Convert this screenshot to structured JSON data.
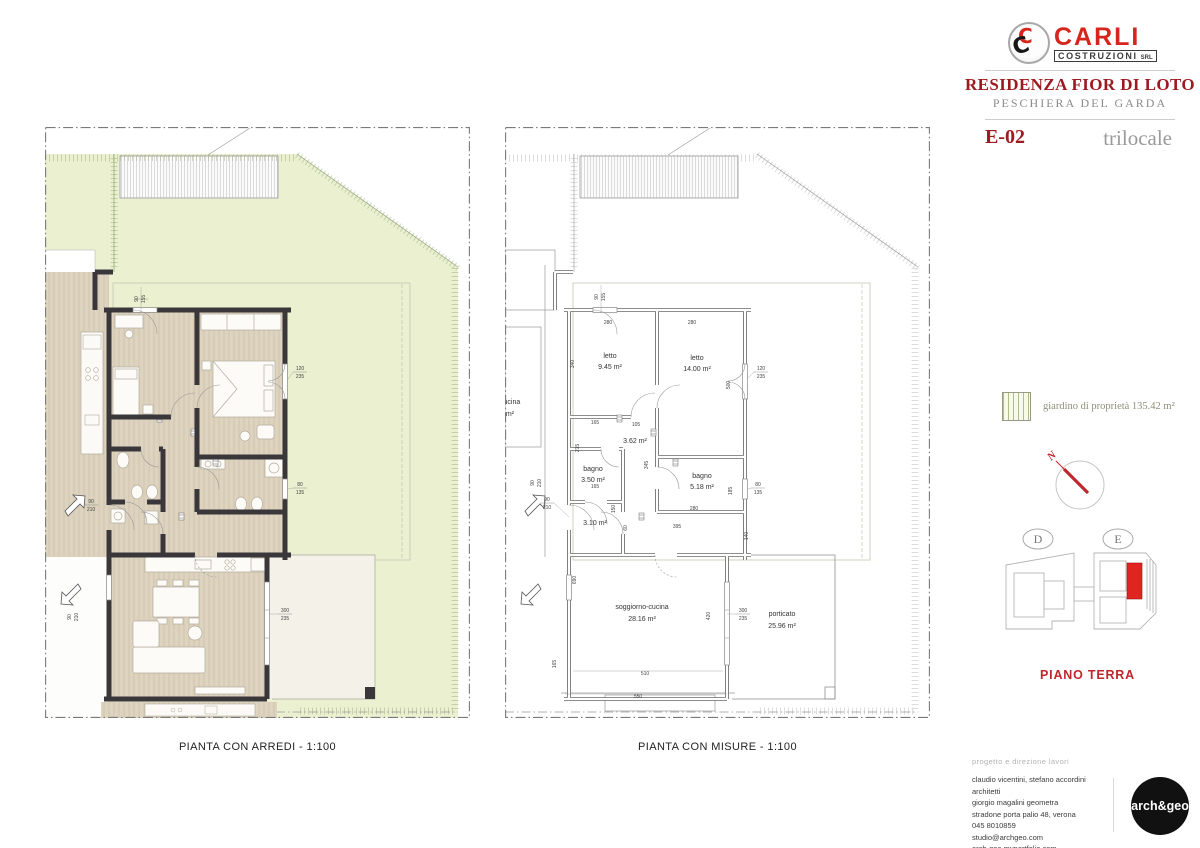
{
  "header": {
    "logo": {
      "initial": "C",
      "name": "CARLI",
      "sub": "COSTRUZIONI",
      "srl": "SRL"
    },
    "project": "RESIDENZA FIOR DI LOTO",
    "location": "PESCHIERA DEL GARDA",
    "unit": "E-02",
    "unit_type": "trilocale"
  },
  "legend": {
    "garden": "giardino di proprietà 135.42 m²"
  },
  "north": {
    "label": "N"
  },
  "keyplan": {
    "building_d": "D",
    "building_e": "E",
    "floor": "PIANO TERRA"
  },
  "captions": {
    "arredi": "PIANTA CON ARREDI - 1:100",
    "misure": "PIANTA CON MISURE - 1:100"
  },
  "rooms": {
    "letto1": {
      "name": "letto",
      "area": "9.45 m²"
    },
    "letto2": {
      "name": "letto",
      "area": "14.00 m²"
    },
    "bagno1": {
      "name": "bagno",
      "area": "3.50 m²"
    },
    "disimpegno1": {
      "area": "3.62 m²"
    },
    "bagno2": {
      "name": "bagno",
      "area": "5.18 m²"
    },
    "disimpegno2": {
      "area": "3.10 m²"
    },
    "soggiorno": {
      "name": "soggiorno-cucina",
      "area": "28.16 m²"
    },
    "porticato": {
      "name": "porticato",
      "area": "25.96 m²"
    },
    "fragment": {
      "name": "p-cucina",
      "area": "1 m²"
    }
  },
  "dims": {
    "d90": "90",
    "d155": "155",
    "d120": "120",
    "d235": "235",
    "d280": "280",
    "d340": "340",
    "d500": "500",
    "d165": "165",
    "d105": "105",
    "d215": "215",
    "d345": "345",
    "d185": "185",
    "d80": "80",
    "d135": "135",
    "d395": "395",
    "d60": "60",
    "d150": "150",
    "d210": "210",
    "d140": "140",
    "d690": "690",
    "d420": "420",
    "d300": "300",
    "d510": "510",
    "d550": "550"
  },
  "footer": {
    "heading": "progetto e direzione lavori",
    "lines": [
      "claudio vicentini, stefano accordini architetti",
      "giorgio magalini geometra",
      "stradone porta palio 48, verona",
      "045 8010859",
      "studio@archgeo.com",
      "arch-geo.myportfolio.com"
    ],
    "logo": "arch&geo"
  },
  "colors": {
    "accent_red": "#d6251d",
    "title_red": "#9c1b20",
    "garden_green": "#eaf0d0",
    "wall_dark": "#3a373b",
    "floor_beige": "#ddd3bf"
  }
}
